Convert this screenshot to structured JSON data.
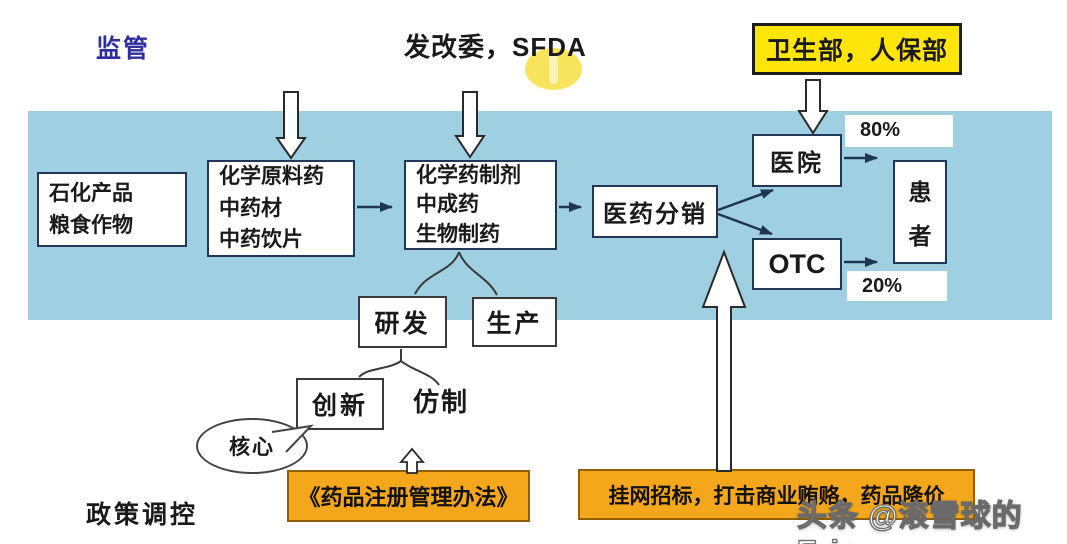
{
  "header": {
    "supervision_label": "监管",
    "regulator_label": "发改委，SFDA",
    "health_box_label": "卫生部，人保部"
  },
  "chain": {
    "raw_materials": {
      "lines": [
        "石化产品",
        "粮食作物"
      ]
    },
    "api": {
      "lines": [
        "化学原料药",
        "中药材",
        "中药饮片"
      ]
    },
    "preparations": {
      "lines": [
        "化学药制剂",
        "中成药",
        "生物制药"
      ]
    },
    "distribution_label": "医药分销",
    "hospital_label": "医院",
    "hospital_share": "80%",
    "otc_label": "OTC",
    "otc_share": "20%",
    "patient_chars": [
      "患",
      "者"
    ]
  },
  "lower": {
    "rnd_label": "研发",
    "production_label": "生产",
    "innovation_label": "创新",
    "generic_label": "仿制",
    "core_label": "核心"
  },
  "policy": {
    "section_label": "政策调控",
    "registration_box_label": "《药品注册管理办法》",
    "tender_box_label": "挂网招标，打击商业贿赂，药品降价"
  },
  "watermark_label": "头条 @滚雪球的Eric",
  "colors": {
    "band_blue": "#9FD0E2",
    "ministry_yellow": "#FFE50A",
    "policy_orange": "#F5A71B",
    "arrow_navy": "#1F3550",
    "supervision_blue": "#2F2F9E",
    "highlight_yellow": "#F7E35C"
  }
}
